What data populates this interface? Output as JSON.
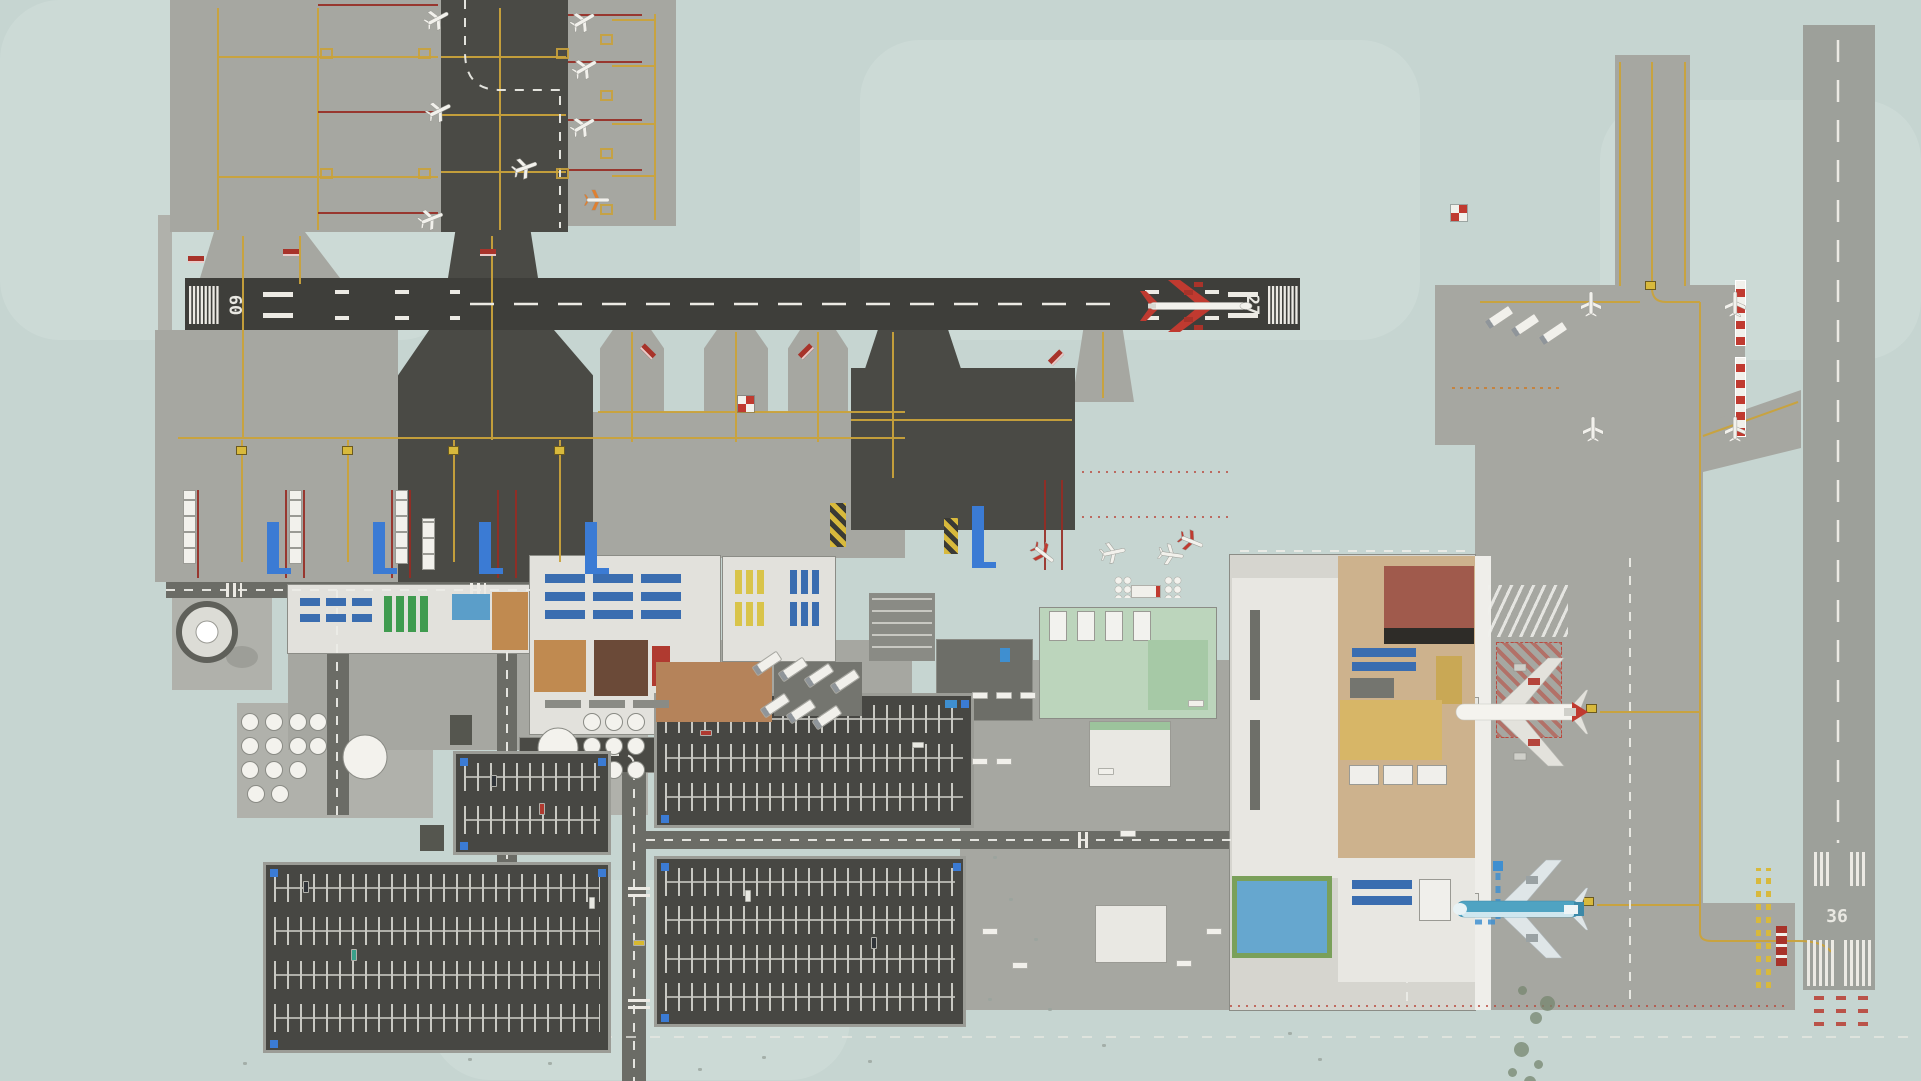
{
  "scene": {
    "title": "Airport overview map"
  },
  "runways": {
    "horizontal": {
      "left_number": "09",
      "right_number": "27"
    },
    "vertical": {
      "bottom_number": "36"
    }
  },
  "colors": {
    "grass": "#c6d5d1",
    "grass_light": "#d2dfda",
    "apron": "#a6a7a1",
    "apron_light": "#b0b1ab",
    "dark_asphalt": "#4a4a45",
    "runway_dark": "#3e3e3a",
    "runway_light": "#9da09a",
    "terminal": "#e2e1dc",
    "terminal2": "#d6d5cf",
    "taxi_yellow": "#c9a23b",
    "marking_white": "#eceae4",
    "red": "#a8332a",
    "blue": "#3b7bd4",
    "wood_floor": "#cdb28d",
    "queue_tan": "#d7b667",
    "brick": "#a05a4c",
    "green_roof": "#bcd5bc",
    "lot": "#474743",
    "road": "#6b6c66",
    "plane_red": "#c03a30",
    "plane_teal": "#4fa3c2"
  }
}
